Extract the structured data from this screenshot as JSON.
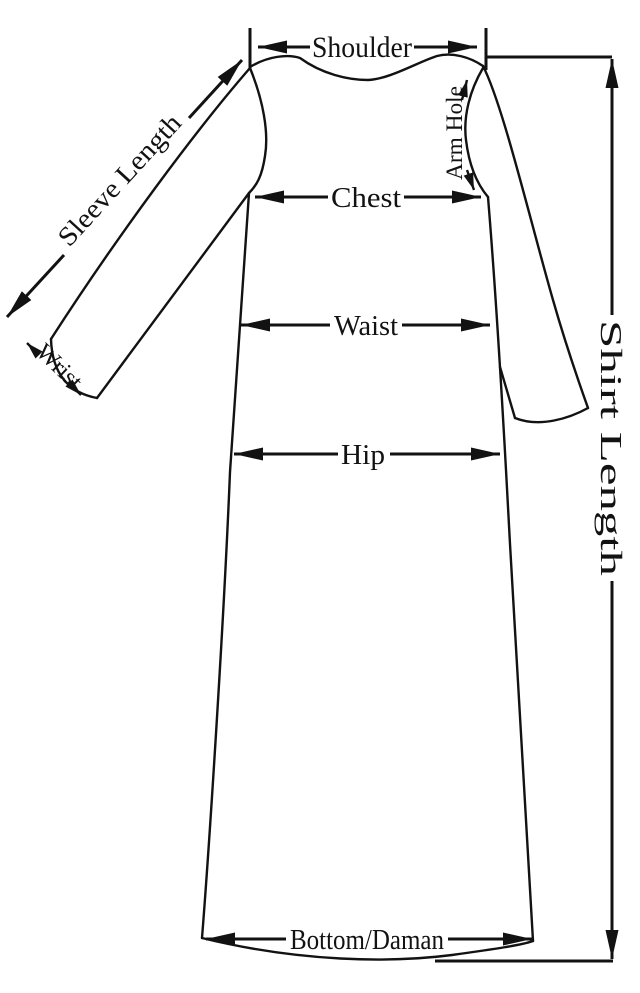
{
  "colors": {
    "ink": "#121212",
    "background": "#ffffff"
  },
  "diagram": {
    "kind": "shirt-measurement-guide",
    "garment": "long shirt with sleeves",
    "labels": {
      "shoulder": "Shoulder",
      "sleeve_length": "Sleeve Length",
      "wrist": "Wrist",
      "arm_hole": "Arm Hole",
      "chest": "Chest",
      "waist": "Waist",
      "hip": "Hip",
      "shirt_length": "Shirt Length",
      "bottom_daman": "Bottom/Daman"
    }
  }
}
